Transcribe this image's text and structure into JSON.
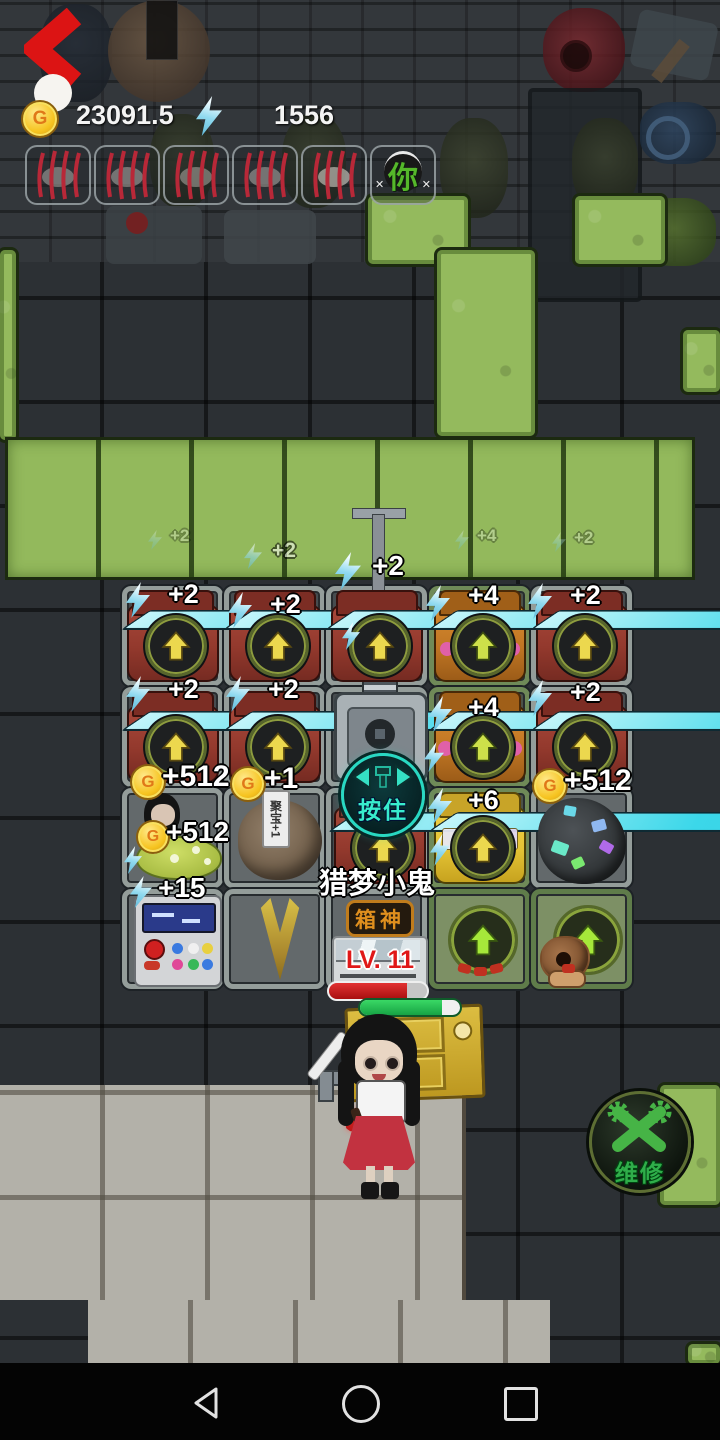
{
  "header": {
    "coin_glyph": "G",
    "coin_value": "23091.5",
    "energy_value": "1556"
  },
  "slot_bar": {
    "char_label": "你"
  },
  "floats": [
    {
      "text": "+2"
    },
    {
      "text": "+2"
    },
    {
      "text": "+2"
    },
    {
      "text": "+4"
    },
    {
      "text": "+2"
    }
  ],
  "labels": {
    "r1c1": "+2",
    "r1c2": "+2",
    "r1c4": "+4",
    "r1c5": "+2",
    "r2c1": "+2",
    "r2c2": "+2",
    "r2c4": "+4",
    "r2c5": "+2",
    "r3c4": "+6",
    "coin_a": "+512",
    "coin_b": "+1",
    "coin_c": "+512",
    "coin_d": "+512",
    "energy": "+15",
    "boulder_tag": "聚宝+1"
  },
  "boss": {
    "name": "猎梦小鬼",
    "badge": "箱神",
    "level": "LV. 11"
  },
  "buttons": {
    "hold": "按住",
    "repair": "维修"
  }
}
